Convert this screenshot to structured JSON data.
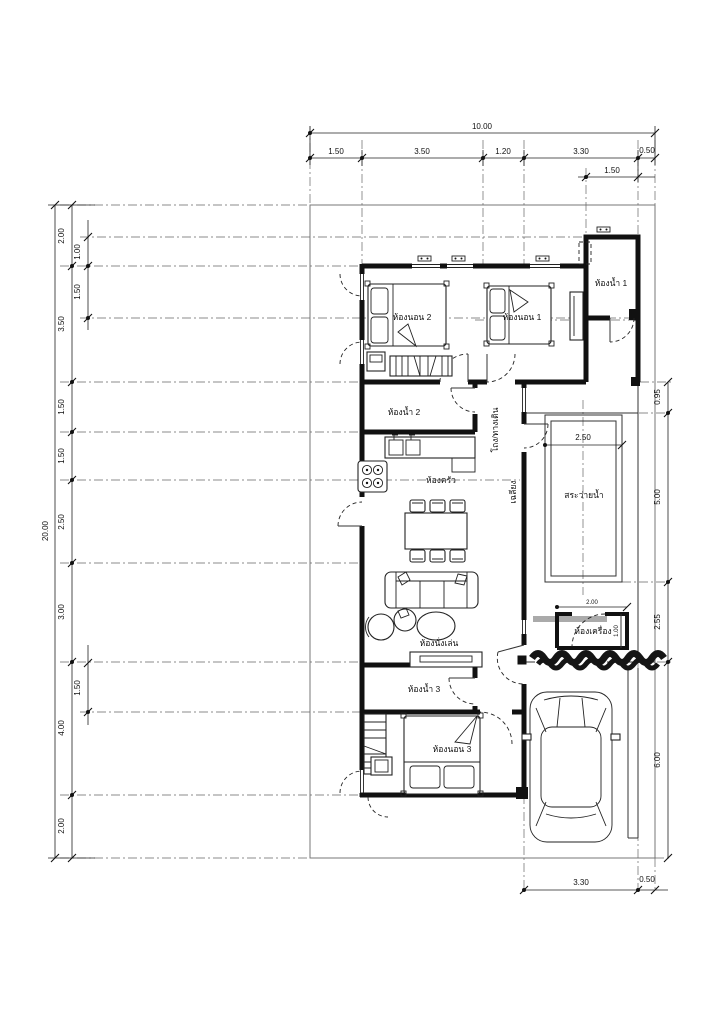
{
  "drawing_type": "house-floor-plan",
  "rooms": {
    "bedroom1": "ห้องนอน 1",
    "bedroom2": "ห้องนอน 2",
    "bedroom3": "ห้องนอน 3",
    "bath1": "ห้องน้ำ 1",
    "bath2": "ห้องน้ำ 2",
    "bath3": "ห้องน้ำ 3",
    "kitchen": "ห้องครัว",
    "living": "ห้องนั่งเล่น",
    "hall": "โถง/ทางเดิน",
    "porch": "เฉลียง",
    "pool": "สระว่ายน้ำ",
    "machine": "ห้องเครื่อง"
  },
  "dims": {
    "top_total": "10.00",
    "top_segments": [
      "1.50",
      "3.50",
      "1.20",
      "3.30",
      "0.50"
    ],
    "top_sub": "1.50",
    "left_total": "20.00",
    "left_segments": [
      "2.00",
      "3.50",
      "1.50",
      "1.50",
      "2.50",
      "3.00",
      "4.00",
      "2.00"
    ],
    "left_subs_top": [
      "1.00",
      "1.50"
    ],
    "left_sub_bottom": "1.50",
    "right_segments": [
      "0.95",
      "5.00",
      "2.55",
      "6.00"
    ],
    "bottom_segments": [
      "3.30",
      "0.50"
    ],
    "pool_width": "2.50",
    "machine_width": "2.00",
    "machine_depth": "1.00"
  },
  "colors": {
    "line": "#111111",
    "background": "#ffffff"
  }
}
